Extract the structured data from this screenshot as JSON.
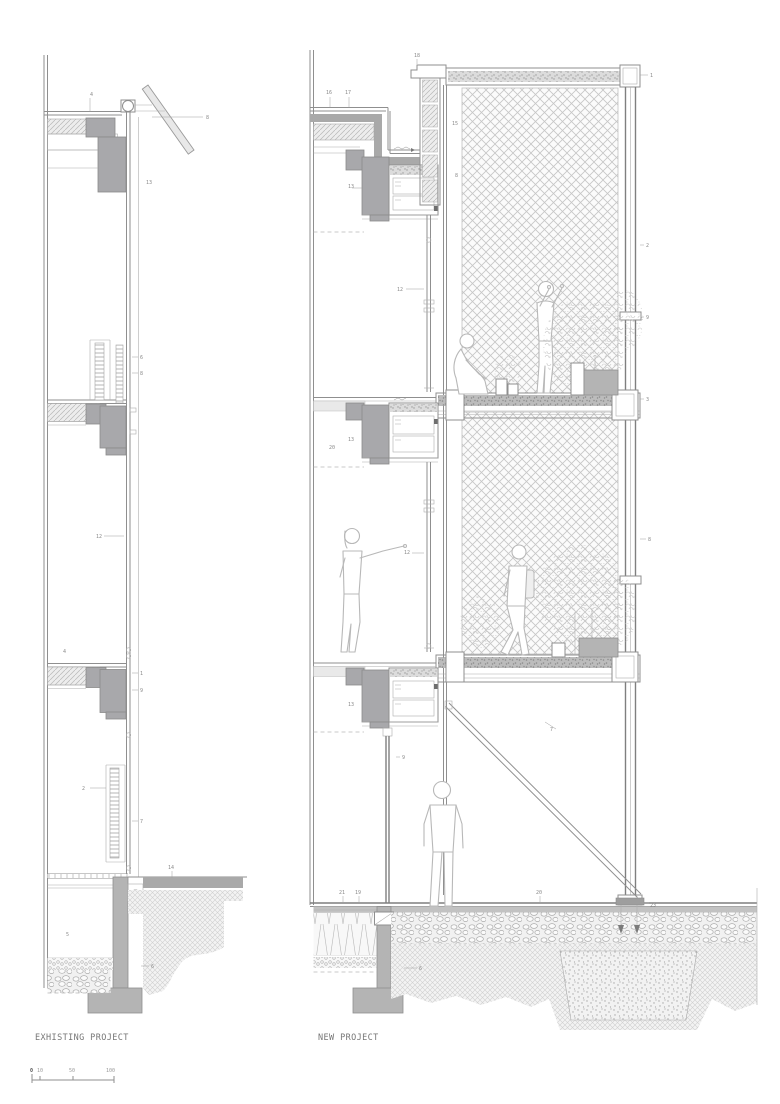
{
  "page": {
    "width": 780,
    "height": 1104,
    "background": "#ffffff"
  },
  "titles": {
    "existing": "EXHISTING PROJECT",
    "new": "NEW PROJECT"
  },
  "scale_bar": {
    "ticks": [
      "0",
      "10",
      "50",
      "100"
    ]
  },
  "colors": {
    "line": "#8f8f8f",
    "line_light": "#b5b5b5",
    "concrete_fill": "#a8a8ab",
    "footing_fill": "#b4b4b4",
    "waterproof_band": "#a9a9a9",
    "mesh_line": "#c6c6c6",
    "hatch_bg": "#ededed",
    "label_text": "#767676"
  },
  "callouts": {
    "existing": [
      "4",
      "8",
      "13",
      "6",
      "8",
      "12",
      "4",
      "1",
      "9",
      "2",
      "7",
      "14",
      "5",
      "6"
    ],
    "new": [
      "16",
      "17",
      "18",
      "1",
      "13",
      "15",
      "8",
      "12",
      "2",
      "9",
      "20",
      "13",
      "12",
      "8",
      "3",
      "13",
      "9",
      "7",
      "21",
      "19",
      "20",
      "23",
      "6"
    ]
  }
}
